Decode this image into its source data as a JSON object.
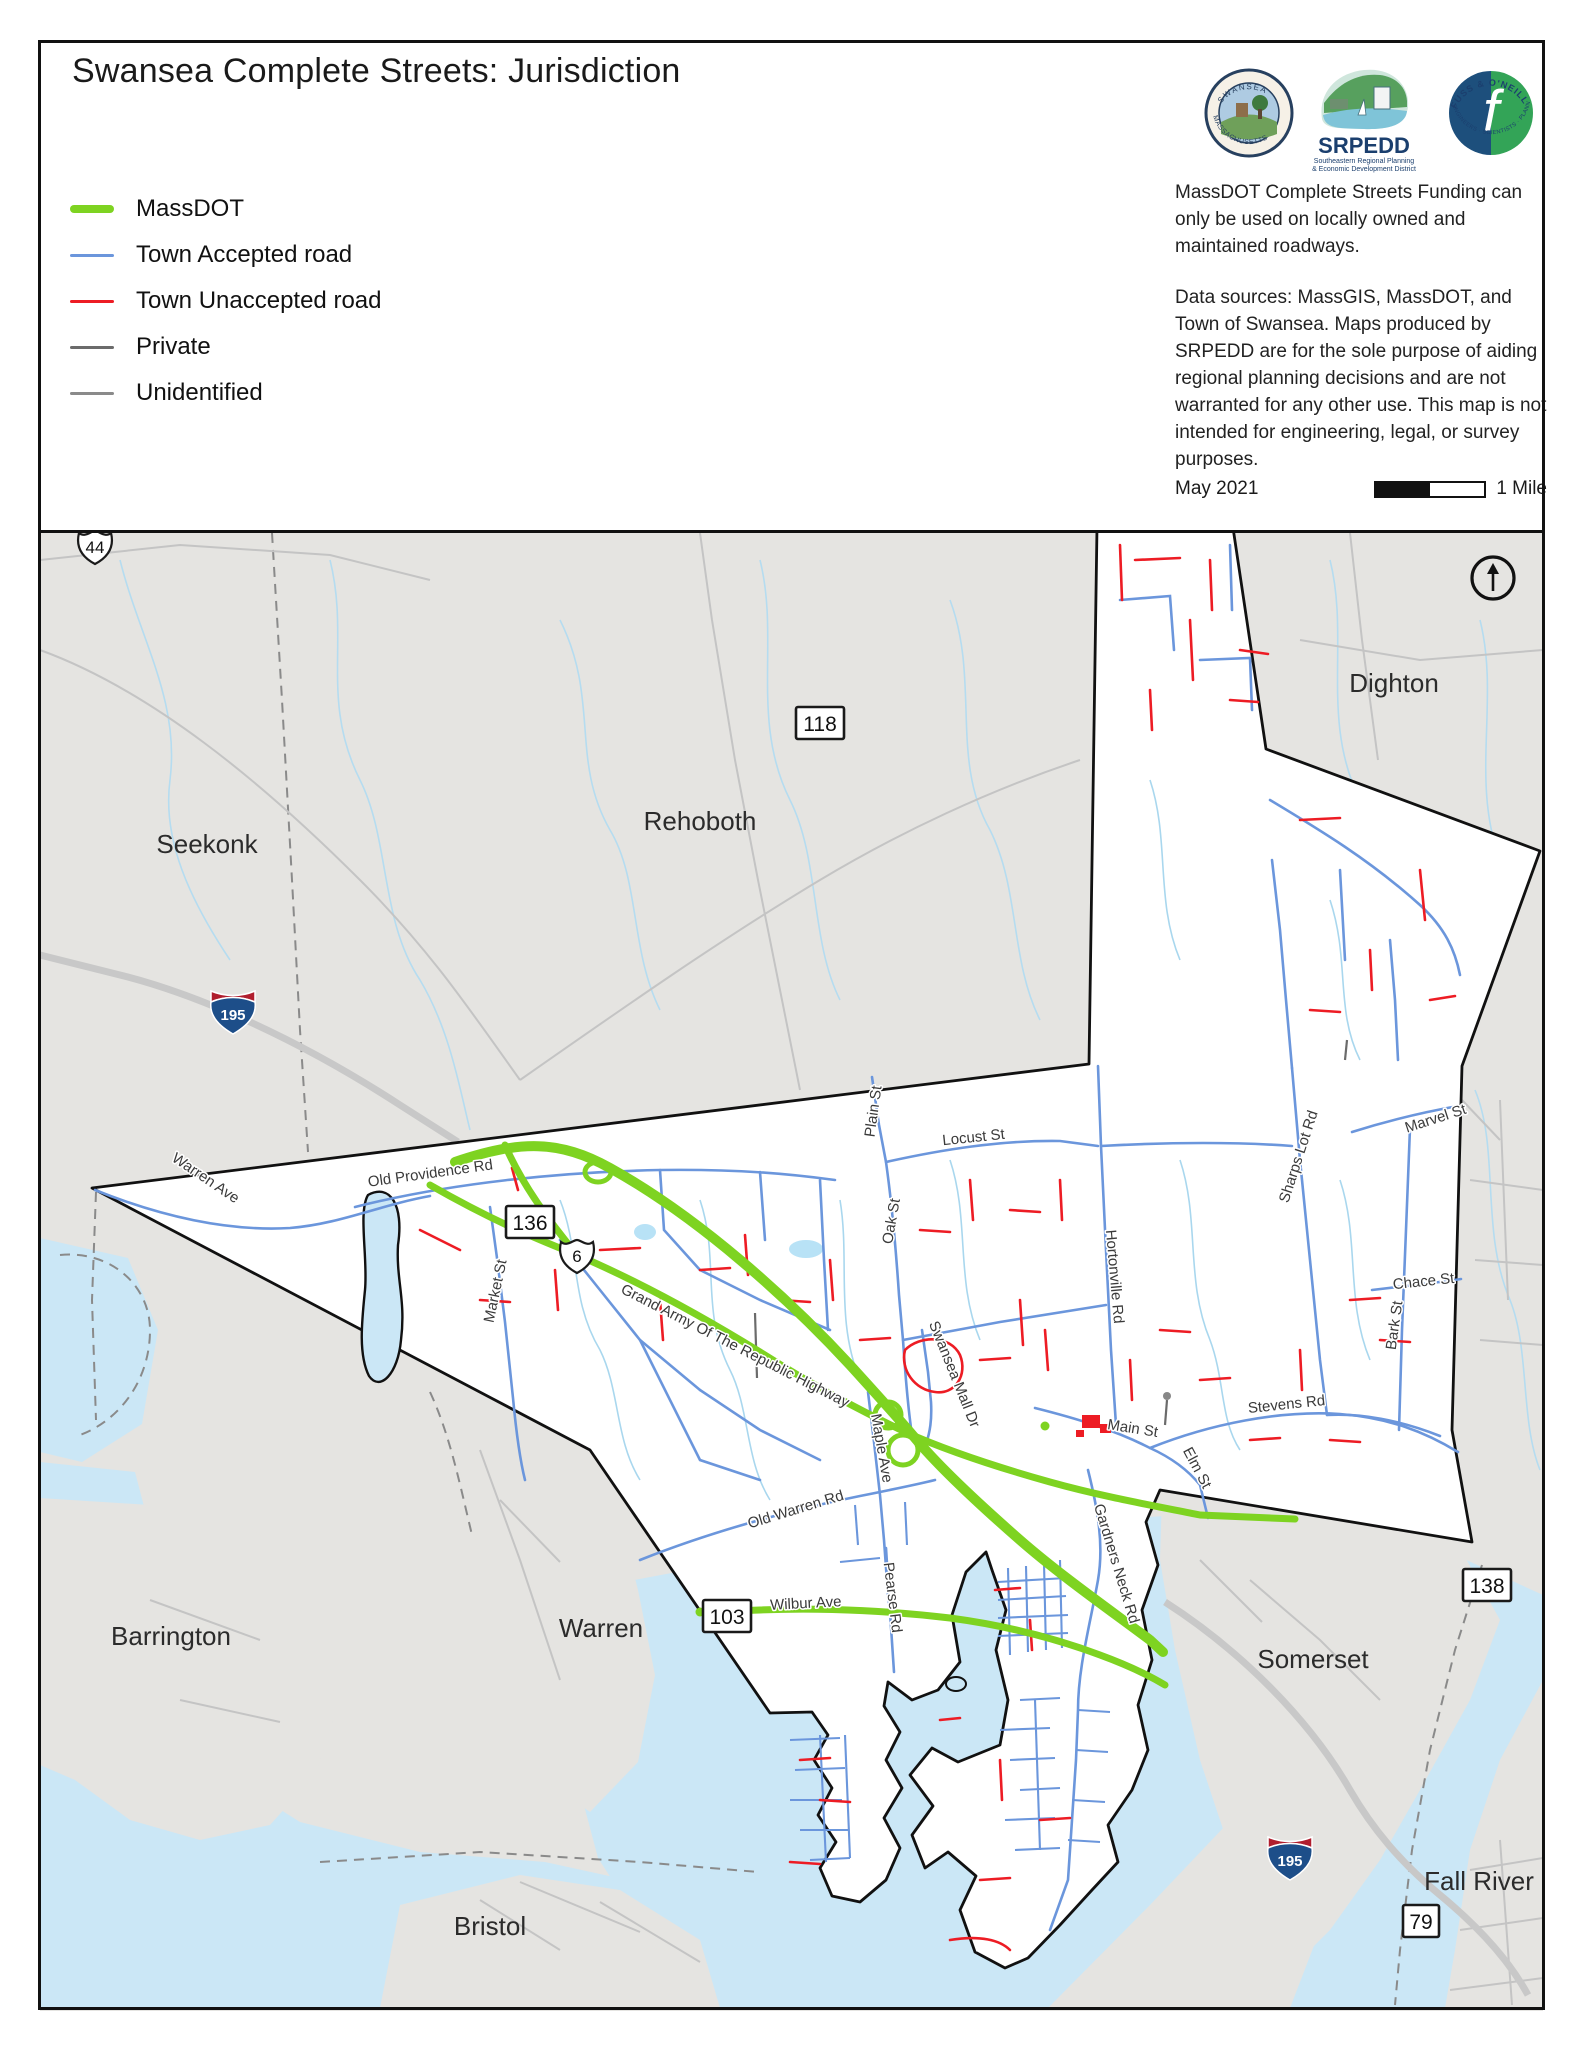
{
  "page": {
    "title": "Swansea Complete Streets: Jurisdiction"
  },
  "legend": {
    "items": [
      {
        "label": "MassDOT",
        "color": "#7ed321",
        "thick": 8
      },
      {
        "label": "Town Accepted road",
        "color": "#6b96dc",
        "thick": 3
      },
      {
        "label": "Town Unaccepted road",
        "color": "#ed1c24",
        "thick": 3
      },
      {
        "label": "Private",
        "color": "#6b6b6b",
        "thick": 3
      },
      {
        "label": "Unidentified",
        "color": "#8a8a8a",
        "thick": 3
      }
    ]
  },
  "logos": {
    "swansea": {
      "top": "SWANSEA",
      "bottom": "MASSACHUSETTS"
    },
    "srpedd": {
      "name": "SRPEDD",
      "tag1": "Southeastern Regional Planning",
      "tag2": "& Economic Development District"
    },
    "fuss": {
      "top": "FUSS & O'NEILL",
      "bottom": "ENGINEERS · SCIENTISTS · PLANNERS",
      "letter": "f"
    }
  },
  "notes": {
    "funding": "MassDOT Complete Streets Funding can only be used on locally owned and maintained roadways.",
    "sources": "Data sources: MassGIS, MassDOT,  and Town of Swansea. Maps produced by SRPEDD are for the sole purpose of aiding regional planning decisions and are not warranted for any other use. This map is not intended for engineering, legal, or survey purposes.",
    "date": "May 2021",
    "scale_label": "1 Mile"
  },
  "map": {
    "colors": {
      "massdot": "#7ed321",
      "accepted": "#6b96dc",
      "unaccepted": "#ed1c24",
      "private": "#6b6b6b",
      "unidentified": "#8a8a8a",
      "water": "#cbe7f6",
      "land": "#e5e4e1",
      "swansea_fill": "#ffffff",
      "boundary": "#111111"
    },
    "towns": [
      {
        "name": "Seekonk",
        "x": 207,
        "y": 853
      },
      {
        "name": "Rehoboth",
        "x": 700,
        "y": 830
      },
      {
        "name": "Dighton",
        "x": 1394,
        "y": 692
      },
      {
        "name": "Barrington",
        "x": 171,
        "y": 1645
      },
      {
        "name": "Warren",
        "x": 601,
        "y": 1637
      },
      {
        "name": "Bristol",
        "x": 490,
        "y": 1935
      },
      {
        "name": "Somerset",
        "x": 1313,
        "y": 1668
      },
      {
        "name": "Fall River",
        "x": 1479,
        "y": 1890
      }
    ],
    "roads": [
      {
        "name": "Warren Ave",
        "x": 203,
        "y": 1182,
        "rot": 34
      },
      {
        "name": "Old Providence Rd",
        "x": 431,
        "y": 1178,
        "rot": -8
      },
      {
        "name": "Market St",
        "x": 500,
        "y": 1292,
        "rot": -78
      },
      {
        "name": "Grand Army Of The Republic Highway",
        "x": 733,
        "y": 1350,
        "rot": 27
      },
      {
        "name": "Maple Ave",
        "x": 877,
        "y": 1449,
        "rot": 80
      },
      {
        "name": "Swansea Mall Dr",
        "x": 950,
        "y": 1376,
        "rot": 68
      },
      {
        "name": "Plain St",
        "x": 878,
        "y": 1112,
        "rot": -82
      },
      {
        "name": "Oak St",
        "x": 896,
        "y": 1222,
        "rot": -80
      },
      {
        "name": "Locust St",
        "x": 974,
        "y": 1142,
        "rot": -6
      },
      {
        "name": "Hortonville Rd",
        "x": 1110,
        "y": 1277,
        "rot": 85
      },
      {
        "name": "Sharps Lot Rd",
        "x": 1303,
        "y": 1158,
        "rot": -72
      },
      {
        "name": "Marvel St",
        "x": 1437,
        "y": 1123,
        "rot": -18
      },
      {
        "name": "Chace St",
        "x": 1424,
        "y": 1286,
        "rot": -6
      },
      {
        "name": "Bark St",
        "x": 1399,
        "y": 1326,
        "rot": -82
      },
      {
        "name": "Stevens Rd",
        "x": 1287,
        "y": 1409,
        "rot": -6
      },
      {
        "name": "Main St",
        "x": 1132,
        "y": 1433,
        "rot": 9
      },
      {
        "name": "Elm St",
        "x": 1193,
        "y": 1470,
        "rot": 62
      },
      {
        "name": "Old Warren Rd",
        "x": 797,
        "y": 1514,
        "rot": -17
      },
      {
        "name": "Wilbur Ave",
        "x": 806,
        "y": 1608,
        "rot": -3
      },
      {
        "name": "Pearse Rd",
        "x": 888,
        "y": 1598,
        "rot": 83
      },
      {
        "name": "Gardners Neck Rd",
        "x": 1112,
        "y": 1565,
        "rot": 73
      }
    ],
    "shields": [
      {
        "type": "us",
        "text": "44",
        "x": 95,
        "y": 547
      },
      {
        "type": "state",
        "text": "118",
        "x": 820,
        "y": 723
      },
      {
        "type": "interstate",
        "text": "195",
        "x": 233,
        "y": 1010
      },
      {
        "type": "state",
        "text": "136",
        "x": 530,
        "y": 1222
      },
      {
        "type": "us",
        "text": "6",
        "x": 577,
        "y": 1256
      },
      {
        "type": "state",
        "text": "103",
        "x": 727,
        "y": 1616
      },
      {
        "type": "state",
        "text": "138",
        "x": 1487,
        "y": 1585
      },
      {
        "type": "interstate",
        "text": "195",
        "x": 1290,
        "y": 1856
      },
      {
        "type": "state",
        "text": "79",
        "x": 1421,
        "y": 1921
      }
    ]
  }
}
